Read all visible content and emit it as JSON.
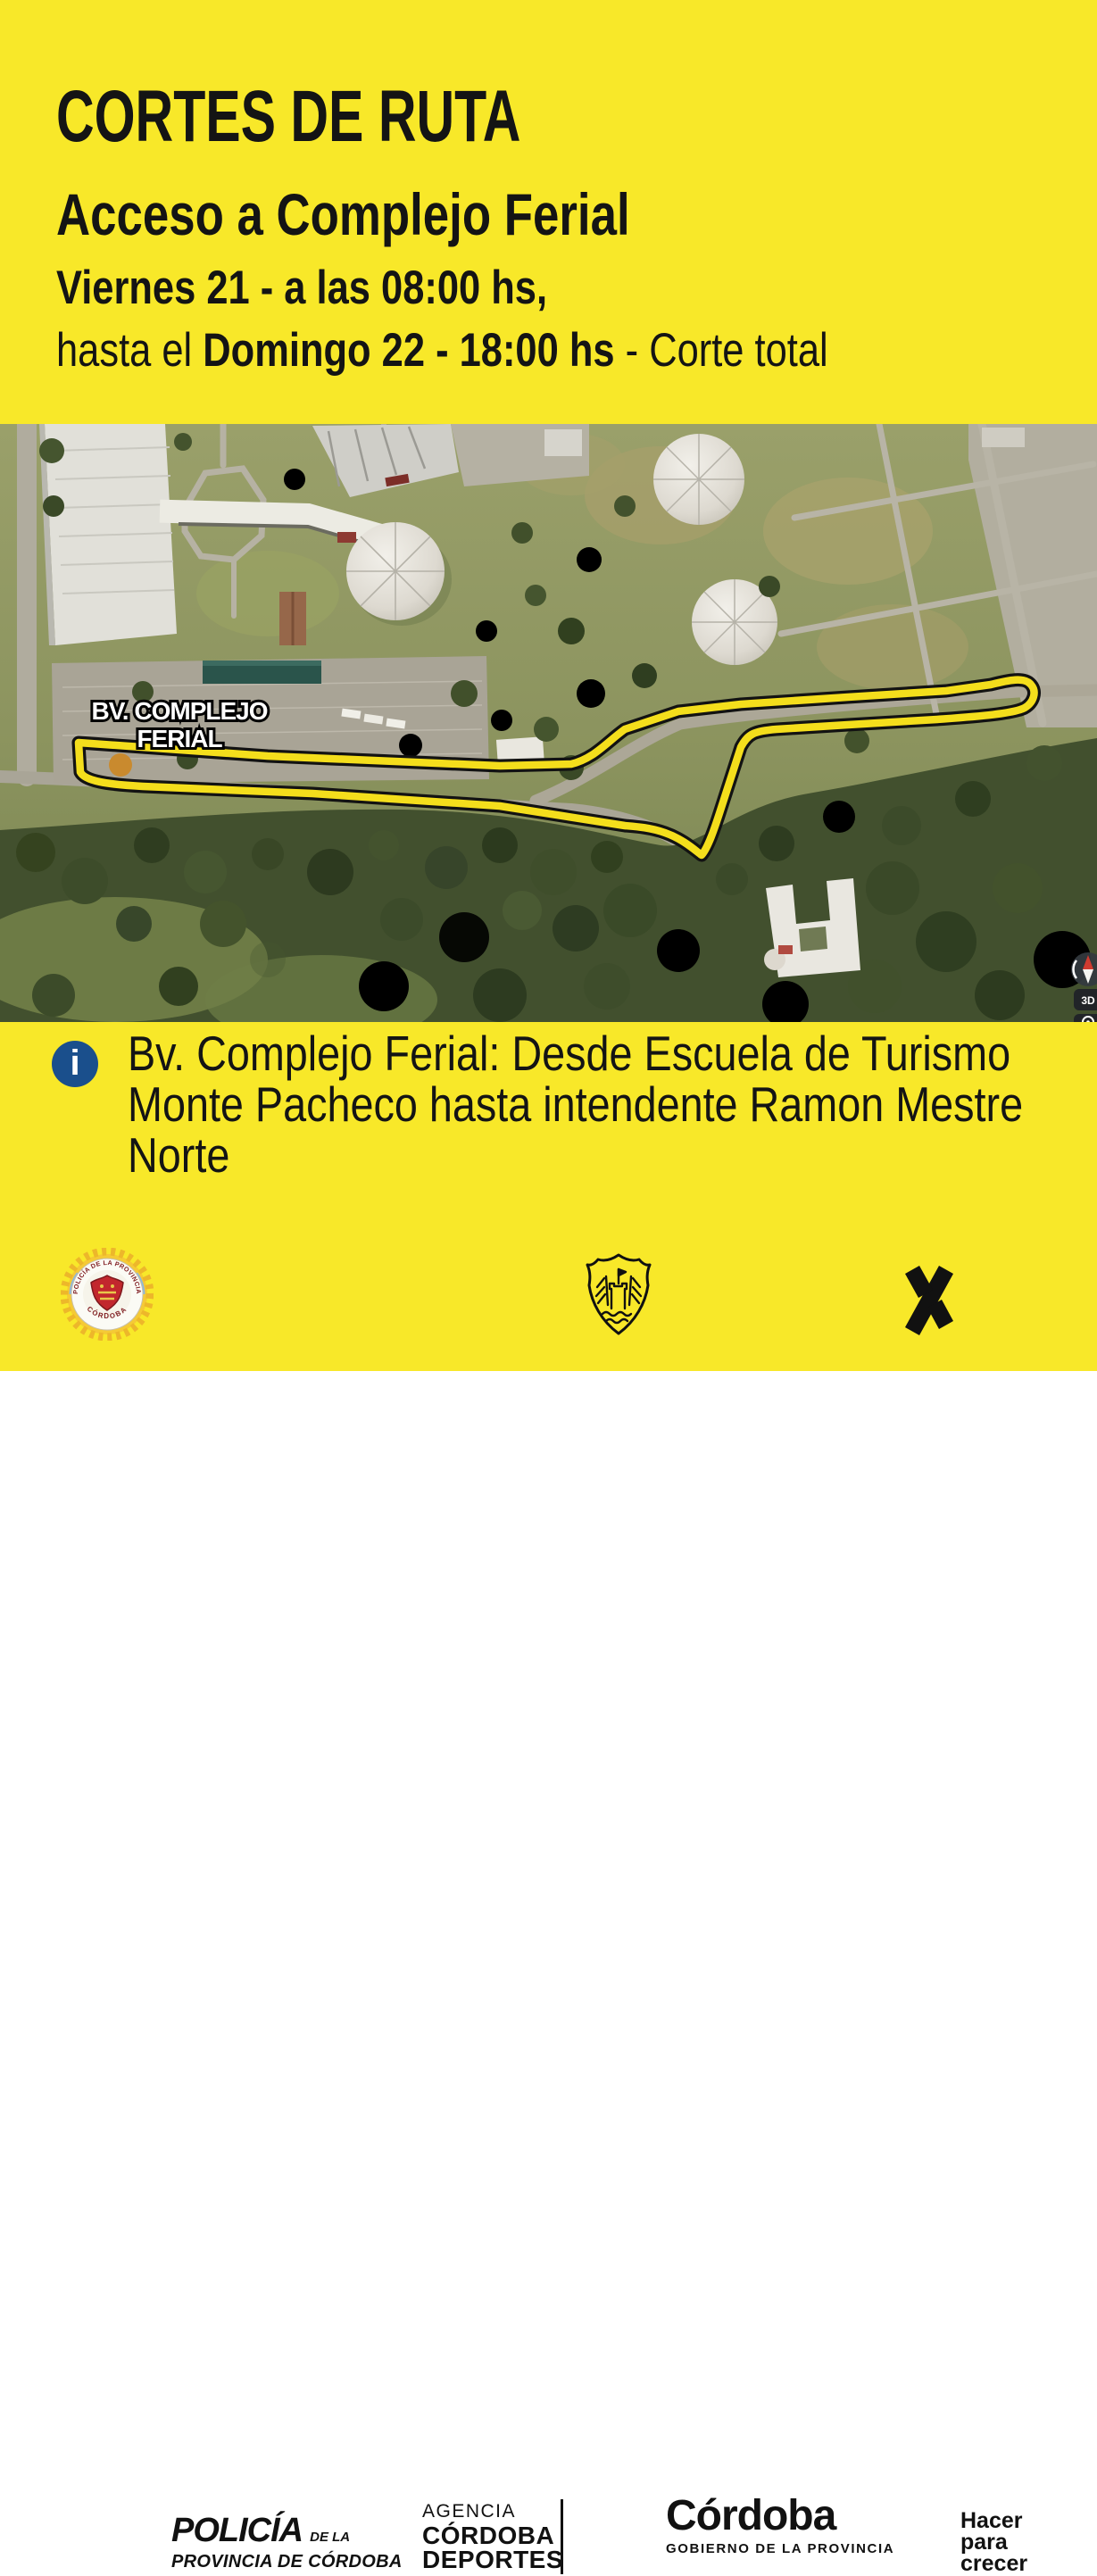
{
  "poster": {
    "title": "CORTES DE RUTA",
    "subtitle": "Acceso a Complejo Ferial",
    "schedule_line1": "Viernes 21 - a las 08:00 hs,",
    "schedule_line2_prefix": "hasta el ",
    "schedule_line2_bold": "Domingo 22 - 18:00 hs",
    "schedule_line2_suffix": " - Corte total",
    "colors": {
      "background": "#F8E829",
      "text": "#141414",
      "route_yellow": "#F4DE1C",
      "route_outline": "#121212",
      "info_icon_blue": "#1A4F8C",
      "badge_red": "#C2272D"
    }
  },
  "map": {
    "road_label_line1": "BV. COMPLEJO",
    "road_label_line2": "FERIAL",
    "controls": {
      "threeD": "3D"
    }
  },
  "info": {
    "icon_glyph": "i",
    "line1": "Bv. Complejo Ferial: Desde Escuela de Turismo",
    "line2": "Monte Pacheco hasta intendente Ramon Mestre",
    "line3": "Norte"
  },
  "footer": {
    "police": {
      "badge_ring_top": "POLICÍA DE LA PROVINCIA",
      "badge_ring_bottom": "CÓRDOBA",
      "name": "POLICÍA",
      "name_suffix": "DE LA",
      "subname": "PROVINCIA DE CÓRDOBA"
    },
    "agency": {
      "line1": "AGENCIA",
      "line2": "CÓRDOBA",
      "line3": "DEPORTES"
    },
    "gobierno": {
      "name": "Córdoba",
      "subname": "GOBIERNO DE LA PROVINCIA"
    },
    "slogan": {
      "line1": "Hacer",
      "line2": "para",
      "line3": "crecer"
    }
  }
}
